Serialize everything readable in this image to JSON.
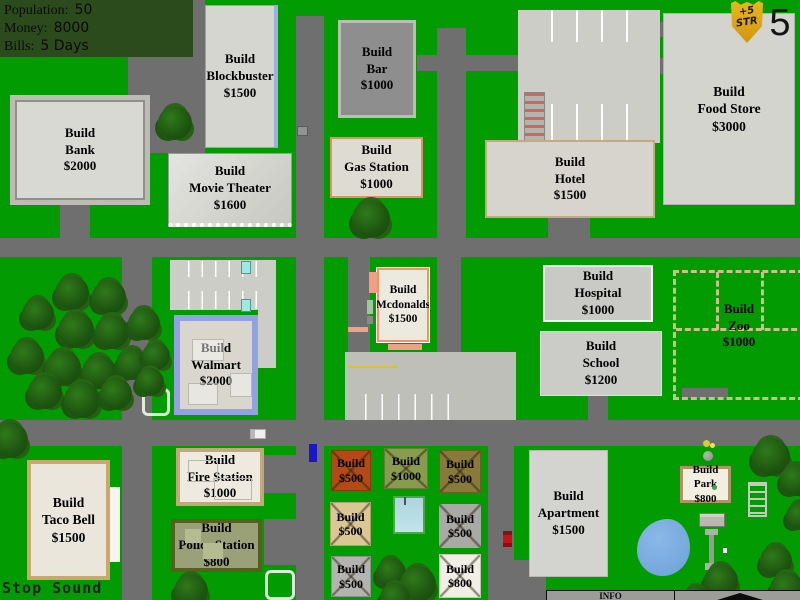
{
  "hud": {
    "stats_panel": {
      "rows": [
        {
          "label": "Population:",
          "value": "50"
        },
        {
          "label": "Money:",
          "value": "8000"
        },
        {
          "label": "Bills:",
          "value": "5 Days"
        }
      ]
    },
    "strength_badge": {
      "line1": "+5",
      "line2": "STR"
    },
    "day_counter": "5",
    "stop_sound_button": "Stop Sound",
    "info_bar": {
      "title": "INFO"
    }
  },
  "buildings": {
    "bank": {
      "l1": "Build",
      "l2": "Bank",
      "l3": "$2000"
    },
    "blockbuster": {
      "l1": "Build",
      "l2": "Blockbuster",
      "l3": "$1500"
    },
    "movie_theater": {
      "l1": "Build",
      "l2": "Movie Theater",
      "l3": "$1600"
    },
    "bar": {
      "l1": "Build",
      "l2": "Bar",
      "l3": "$1000"
    },
    "gas_station": {
      "l1": "Build",
      "l2": "Gas Station",
      "l3": "$1000"
    },
    "food_store": {
      "l1": "Build",
      "l2": "Food Store",
      "l3": "$3000"
    },
    "hotel": {
      "l1": "Build",
      "l2": "Hotel",
      "l3": "$1500"
    },
    "hospital": {
      "l1": "Build",
      "l2": "Hospital",
      "l3": "$1000"
    },
    "school": {
      "l1": "Build",
      "l2": "School",
      "l3": "$1200"
    },
    "zoo": {
      "l1": "Build",
      "l2": "Zoo",
      "l3": "$1000"
    },
    "mcdonalds": {
      "l1": "Build",
      "l2": "Mcdonalds",
      "l3": "$1500"
    },
    "walmart": {
      "l1": "Build",
      "l2": "Walmart",
      "l3": "$2000"
    },
    "taco_bell": {
      "l1": "Build",
      "l2": "Taco Bell",
      "l3": "$1500"
    },
    "fire_station": {
      "l1": "Build",
      "l2": "Fire Station",
      "l3": "$1000"
    },
    "police_station": {
      "l1": "Build",
      "l2": "Police Station",
      "l3": "$800"
    },
    "apartment": {
      "l1": "Build",
      "l2": "Apartment",
      "l3": "$1500"
    },
    "park": {
      "l1": "Build",
      "l2": "Park",
      "l3": "$800"
    }
  },
  "shops": [
    {
      "l1": "Build",
      "l2": "$500"
    },
    {
      "l1": "Build",
      "l2": "$1000"
    },
    {
      "l1": "Build",
      "l2": "$500"
    },
    {
      "l1": "Build",
      "l2": "$500"
    },
    {
      "l1": "Build",
      "l2": "$500"
    },
    {
      "l1": "Build",
      "l2": "$500"
    },
    {
      "l1": "Build",
      "l2": "$800"
    }
  ],
  "palette": {
    "grass": "#029c02",
    "road": "#6f6f6f",
    "panel_green": "#2b4b1d",
    "badge_gold": "#e0a81c",
    "blockbuster_blue": "#a0aee0",
    "walmart_blue": "#92a2e0",
    "gas_border": "#e09068",
    "mcdonalds_border": "#f09468",
    "hotel_border": "#c4aa7c",
    "taco_border": "#c9a76e",
    "police_olive": "#9aa077",
    "police_border": "#565e20",
    "shop_rust": "#b34a16",
    "shop_olive": "#8a9a4e",
    "shop_khaki": "#8a7a3a",
    "shop_tan": "#d9c795",
    "shop_gray": "#a9a9a5",
    "shop_white": "#f1eee5",
    "pond_blue": "#6ea0d8",
    "zoo_fence_tan": "#cdbf8c"
  }
}
